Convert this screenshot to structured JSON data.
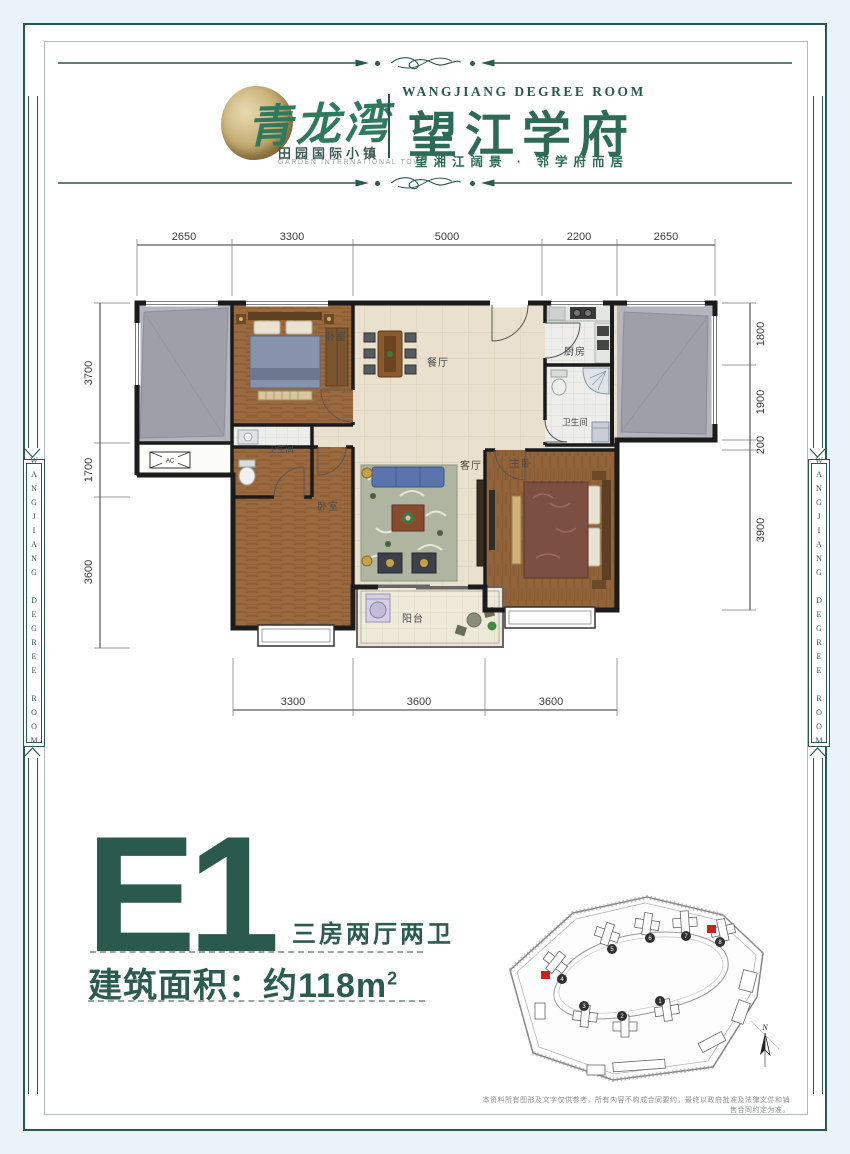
{
  "page": {
    "bg_color": "#eaf2fa",
    "accent_color": "#2a5a4e",
    "red_marker_color": "#cd2020"
  },
  "header": {
    "logo_left": {
      "brand_script": "青龙湾",
      "subtitle_cn": "田园国际小镇",
      "subtitle_en": "GARDEN INTERNATIONAL TOWN"
    },
    "logo_right": {
      "title_en": "WANGJIANG DEGREE ROOM",
      "title_cn": "望江学府",
      "tagline": "望湘江阔景 · 邻学府而居"
    }
  },
  "side_band": {
    "text": "WANGJIANG DEGREE ROOM"
  },
  "floorplan": {
    "dims_top": [
      "2650",
      "3300",
      "5000",
      "2200",
      "2650"
    ],
    "dims_bottom": [
      "3300",
      "3600",
      "3600"
    ],
    "dims_left": [
      "3700",
      "1700",
      "3600"
    ],
    "dims_right": [
      "1800",
      "1900",
      "200",
      "3900"
    ],
    "rooms": {
      "bedroom_top": "卧室",
      "bedroom_bottom": "卧室",
      "master": "主卧",
      "living": "客厅",
      "dining": "餐厅",
      "kitchen": "厨房",
      "bath1": "卫生间",
      "bath2": "卫生间",
      "balcony": "阳台",
      "ac": "AC"
    }
  },
  "unit": {
    "code": "E1",
    "layout": "三房两厅两卫",
    "area_label": "建筑面积：约118m",
    "area_sup": "2"
  },
  "siteplan": {
    "building_numbers": [
      "1",
      "2",
      "3",
      "4",
      "5",
      "6",
      "7",
      "8"
    ],
    "compass": "N"
  },
  "disclaimer": "本资料所有图形及文字仅供参考，所有内容不构成合同要约，最终以政府批准及法律文件和销售合同约定为准。"
}
